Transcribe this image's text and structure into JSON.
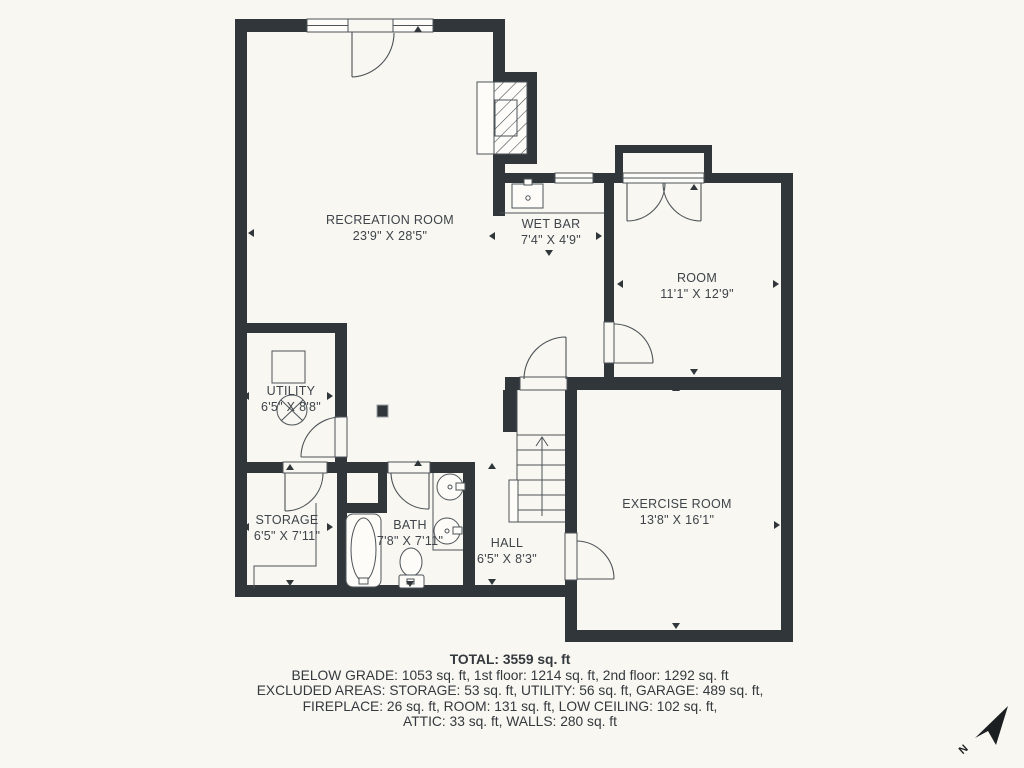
{
  "colors": {
    "background": "#f8f7f1",
    "wall": "#30363a",
    "thin_line": "#4d5358",
    "label_text": "#3e444a",
    "summary_text": "#34393e"
  },
  "rooms": [
    {
      "name": "RECREATION ROOM",
      "dims": "23'9\" X 28'5\""
    },
    {
      "name": "WET BAR",
      "dims": "7'4\" X 4'9\""
    },
    {
      "name": "ROOM",
      "dims": "11'1\" X 12'9\""
    },
    {
      "name": "UTILITY",
      "dims": "6'5\" X 8'8\""
    },
    {
      "name": "STORAGE",
      "dims": "6'5\" X 7'11\""
    },
    {
      "name": "BATH",
      "dims": "7'8\" X 7'11\""
    },
    {
      "name": "HALL",
      "dims": "6'5\" X 8'3\""
    },
    {
      "name": "EXERCISE ROOM",
      "dims": "13'8\" X 16'1\""
    }
  ],
  "fixtures": [
    "fireplace",
    "wet-bar-sink",
    "french-doors",
    "stairs-up",
    "water-heater",
    "furnace",
    "column",
    "bathtub",
    "toilet",
    "sink",
    "counter",
    "north-arrow"
  ],
  "summary": {
    "total": "TOTAL: 3559 sq. ft",
    "lines": [
      "BELOW GRADE: 1053 sq. ft, 1st floor: 1214 sq. ft, 2nd floor: 1292 sq. ft",
      "EXCLUDED AREAS: STORAGE: 53 sq. ft, UTILITY: 56 sq. ft, GARAGE: 489 sq. ft,",
      "FIREPLACE: 26 sq. ft, ROOM: 131 sq. ft, LOW CEILING: 102 sq. ft,",
      "ATTIC: 33 sq. ft, WALLS: 280 sq. ft"
    ]
  },
  "compass": {
    "north_label": "N"
  }
}
